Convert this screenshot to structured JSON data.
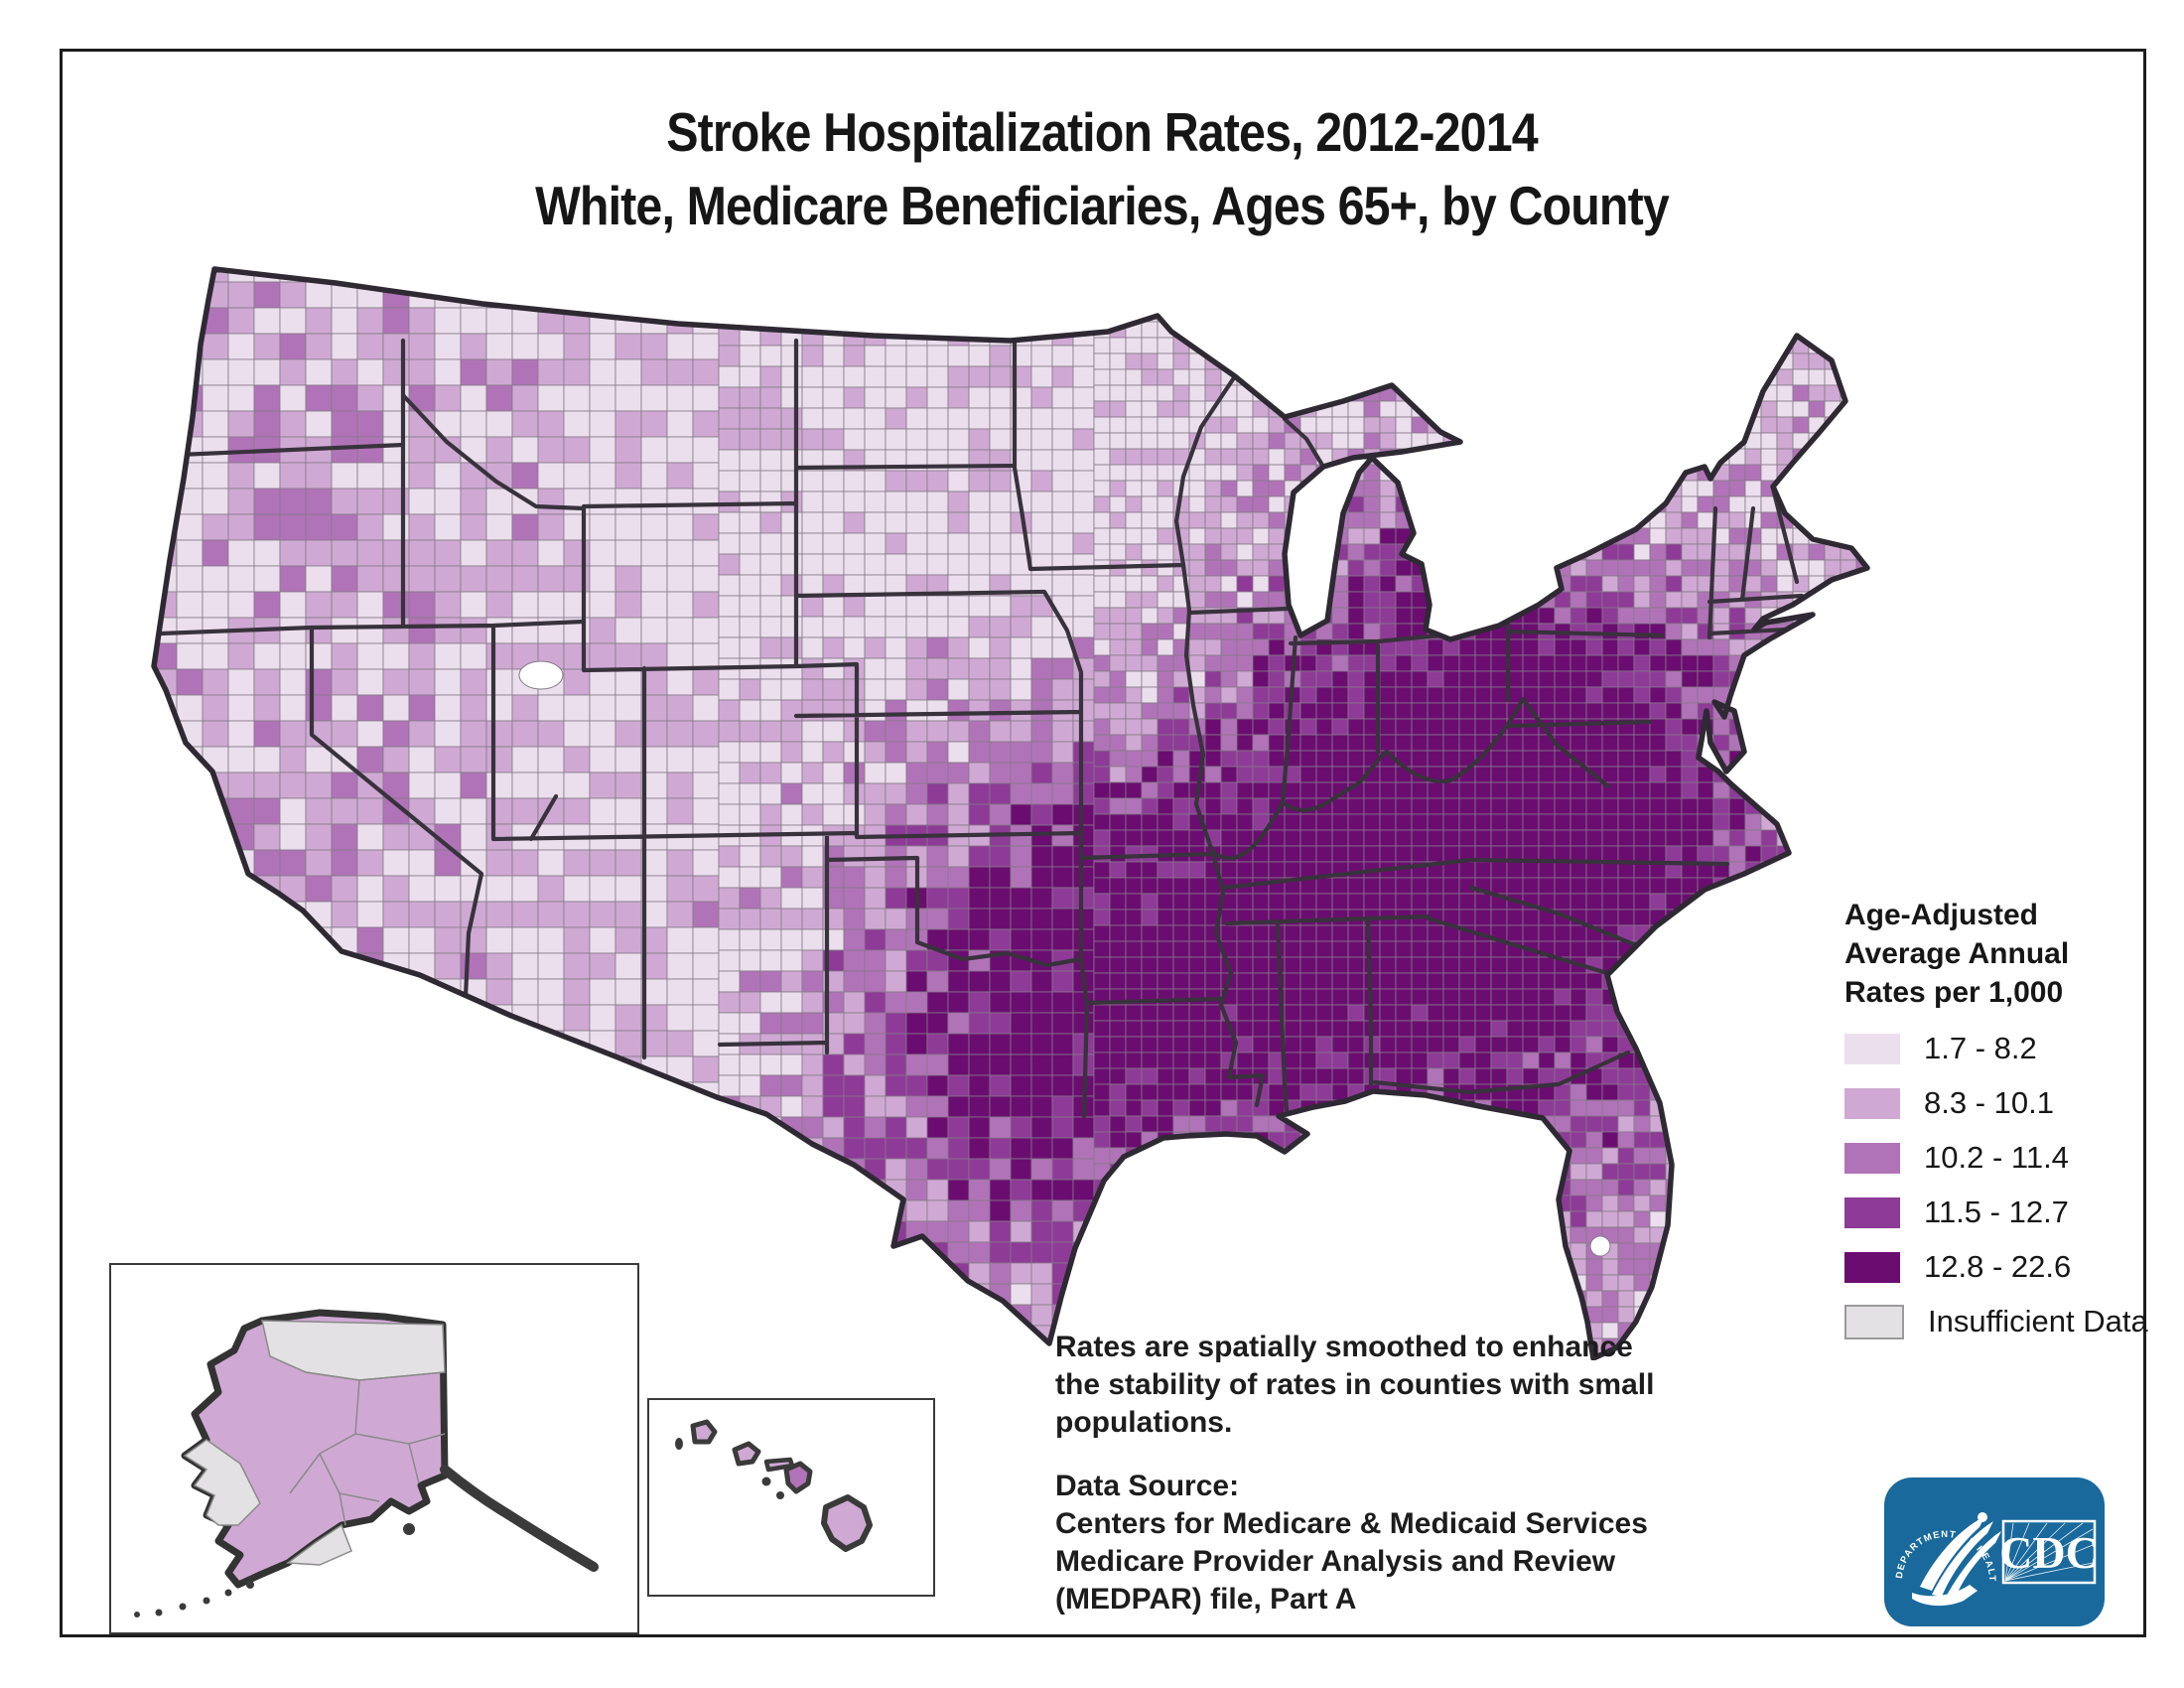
{
  "title": {
    "line1": "Stroke Hospitalization Rates, 2012-2014",
    "line2": "White, Medicare Beneficiaries, Ages 65+, by County"
  },
  "legend": {
    "title": "Age-Adjusted\nAverage Annual\nRates per 1,000",
    "classes": [
      {
        "label": "1.7 - 8.2",
        "color": "#ECDFED"
      },
      {
        "label": "8.3 - 10.1",
        "color": "#CFA9D3"
      },
      {
        "label": "10.2 - 11.4",
        "color": "#B173B8"
      },
      {
        "label": "11.5 - 12.7",
        "color": "#8E3A97"
      },
      {
        "label": "12.8 - 22.6",
        "color": "#6B0D70"
      }
    ],
    "insufficient": {
      "label": "Insufficient Data",
      "color": "#E3E1E3"
    }
  },
  "notes": {
    "smoothing": "Rates are spatially smoothed to enhance\nthe stability of rates in counties with small\npopulations.",
    "source": "Data Source:\nCenters for Medicare & Medicaid Services\nMedicare Provider Analysis and Review\n(MEDPAR) file, Part A"
  },
  "map": {
    "class_colors": [
      "#ECDFED",
      "#CFA9D3",
      "#B173B8",
      "#8E3A97",
      "#6B0D70"
    ],
    "insufficient_color": "#E3E1E3",
    "county_line": "#847A88",
    "state_line": "#38323C",
    "outline": "#2E2933",
    "water": "#FFFFFF",
    "regions": [
      "contiguous-united-states",
      "alaska",
      "hawaii"
    ]
  },
  "logo": {
    "background": "#19699C",
    "arc_text": "DEPARTMENT OF HEALTH & HUMAN SERVICES · USA",
    "agency": "CDC"
  }
}
